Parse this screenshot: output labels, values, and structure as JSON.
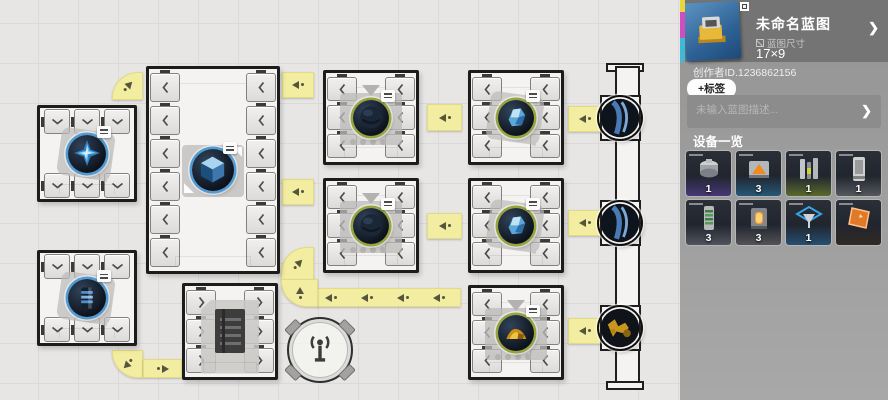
{
  "header": {
    "title": "未命名蓝图",
    "size_label": "蓝图尺寸",
    "size_value": "17×9",
    "chevron": "❯"
  },
  "meta": {
    "creator_id": "创作者ID.1236862156",
    "add_tag_label": "+标签",
    "description_placeholder": "未输入蓝图描述...",
    "chevron": "❯"
  },
  "devices": {
    "section_title": "设备一览",
    "items": [
      {
        "icon": "centrifuge-machine",
        "count": "1",
        "accent": "#7b52d6"
      },
      {
        "icon": "press-machine",
        "count": "3",
        "accent": "#2f9bd8"
      },
      {
        "icon": "pillar-machine",
        "count": "1",
        "accent": "#a9c62c"
      },
      {
        "icon": "cabinet-machine",
        "count": "1",
        "accent": "#9b9b9b"
      },
      {
        "icon": "coil-tower-machine",
        "count": "3",
        "accent": "#8f949b"
      },
      {
        "icon": "furnace-machine",
        "count": "3",
        "accent": "#97928c"
      },
      {
        "icon": "funnel-machine",
        "count": "1",
        "accent": "#2f86c8"
      },
      {
        "icon": "conveyor-panel",
        "count": "",
        "accent": "#4a2f17"
      }
    ]
  },
  "canvas": {
    "grid_cell": 40,
    "machines": [
      {
        "id": "assembler-top-left",
        "x": 37,
        "y": 105,
        "w": 100,
        "h": 97,
        "ports": "tb",
        "pcount": 3,
        "chev": "down",
        "item": "spike-gem",
        "ring": "#4f9bd6",
        "itemd": 38,
        "decor": [
          "shadow",
          "tag"
        ]
      },
      {
        "id": "storage-tall",
        "x": 146,
        "y": 66,
        "w": 134,
        "h": 208,
        "ports": "lr",
        "pcount": 6,
        "chev": "left",
        "item": "cube",
        "ring": "#4f9bd6",
        "itemd": 42,
        "decor": [
          "shadowsq",
          "corner-arrows",
          "tag"
        ]
      },
      {
        "id": "processor-a",
        "x": 323,
        "y": 70,
        "w": 96,
        "h": 95,
        "ports": "lr",
        "pcount": 3,
        "chev": "left",
        "item": "dark-sphere",
        "ring": "#95a53b",
        "itemd": 36,
        "decor": [
          "shadowsq",
          "triangle",
          "dots",
          "tag"
        ]
      },
      {
        "id": "processor-b",
        "x": 468,
        "y": 70,
        "w": 96,
        "h": 95,
        "ports": "lr",
        "pcount": 3,
        "chev": "left",
        "item": "crystal",
        "ring": "#95a53b",
        "itemd": 36,
        "decor": [
          "shadow",
          "tag"
        ]
      },
      {
        "id": "processor-c",
        "x": 323,
        "y": 178,
        "w": 96,
        "h": 95,
        "ports": "lr",
        "pcount": 3,
        "chev": "left",
        "item": "dark-sphere",
        "ring": "#95a53b",
        "itemd": 36,
        "decor": [
          "shadowsq",
          "triangle",
          "dots",
          "tag"
        ]
      },
      {
        "id": "processor-d",
        "x": 468,
        "y": 178,
        "w": 96,
        "h": 95,
        "ports": "lr",
        "pcount": 3,
        "chev": "left",
        "item": "crystal",
        "ring": "#95a53b",
        "itemd": 36,
        "decor": [
          "shadow",
          "tag"
        ]
      },
      {
        "id": "assembler-bottom-left",
        "x": 37,
        "y": 250,
        "w": 100,
        "h": 96,
        "ports": "tb",
        "pcount": 3,
        "chev": "down",
        "item": "capacitor",
        "ring": "#4f9bd6",
        "itemd": 38,
        "decor": [
          "shadow",
          "tag"
        ]
      },
      {
        "id": "shelf-unit",
        "x": 182,
        "y": 283,
        "w": 96,
        "h": 97,
        "ports": "lr",
        "pcount": 3,
        "chev": "right",
        "item": "cabinet",
        "decor": [
          "folder"
        ]
      },
      {
        "id": "processor-e",
        "x": 468,
        "y": 285,
        "w": 96,
        "h": 95,
        "ports": "lr",
        "pcount": 3,
        "chev": "left",
        "item": "gold-ore",
        "ring": "#95a53b",
        "itemd": 36,
        "decor": [
          "shadowsq",
          "triangle",
          "dots",
          "tag"
        ]
      }
    ],
    "belts": [
      {
        "x": 112,
        "y": 72,
        "w": 31,
        "h": 28,
        "shape": "elbow-tl",
        "arrows": [
          {
            "dir": "ne"
          }
        ]
      },
      {
        "x": 282,
        "y": 72,
        "w": 32,
        "h": 26,
        "shape": "straight",
        "arrows": [
          {
            "dir": "w"
          }
        ]
      },
      {
        "x": 427,
        "y": 104,
        "w": 35,
        "h": 27,
        "shape": "straight",
        "arrows": [
          {
            "dir": "w"
          }
        ]
      },
      {
        "x": 568,
        "y": 106,
        "w": 34,
        "h": 26,
        "shape": "straight",
        "arrows": [
          {
            "dir": "w"
          }
        ]
      },
      {
        "x": 282,
        "y": 179,
        "w": 32,
        "h": 26,
        "shape": "straight",
        "arrows": [
          {
            "dir": "w"
          }
        ]
      },
      {
        "x": 427,
        "y": 213,
        "w": 35,
        "h": 26,
        "shape": "straight",
        "arrows": [
          {
            "dir": "w"
          }
        ]
      },
      {
        "x": 568,
        "y": 210,
        "w": 34,
        "h": 26,
        "shape": "straight",
        "arrows": [
          {
            "dir": "w"
          }
        ]
      },
      {
        "x": 568,
        "y": 318,
        "w": 34,
        "h": 26,
        "shape": "straight",
        "arrows": [
          {
            "dir": "w"
          }
        ]
      },
      {
        "x": 317,
        "y": 288,
        "w": 144,
        "h": 19,
        "shape": "straight",
        "arrows": [
          {
            "fx": 0.1,
            "dir": "w"
          },
          {
            "fx": 0.35,
            "dir": "w"
          },
          {
            "fx": 0.6,
            "dir": "w"
          },
          {
            "fx": 0.85,
            "dir": "w"
          }
        ]
      },
      {
        "x": 281,
        "y": 247,
        "w": 33,
        "h": 33,
        "shape": "elbow-tl",
        "arrows": [
          {
            "dir": "ne"
          }
        ]
      },
      {
        "x": 281,
        "y": 279,
        "w": 37,
        "h": 28,
        "shape": "elbow-bl",
        "arrows": [
          {
            "dir": "n"
          }
        ]
      },
      {
        "x": 112,
        "y": 350,
        "w": 31,
        "h": 28,
        "shape": "elbow-bl",
        "arrows": [
          {
            "dir": "sw"
          }
        ]
      },
      {
        "x": 143,
        "y": 359,
        "w": 39,
        "h": 19,
        "shape": "straight",
        "arrows": [
          {
            "dir": "e"
          }
        ]
      }
    ],
    "column": {
      "rails": [
        {
          "x": 606,
          "y": 63,
          "w": 38,
          "h": 9
        },
        {
          "x": 615,
          "y": 66,
          "w": 25,
          "h": 320
        },
        {
          "x": 606,
          "y": 381,
          "w": 38,
          "h": 9
        }
      ],
      "sockets": [
        {
          "x": 600,
          "y": 95,
          "w": 41,
          "h": 46,
          "item": "sphere-blue"
        },
        {
          "x": 600,
          "y": 200,
          "w": 41,
          "h": 46,
          "item": "sphere-blue"
        },
        {
          "x": 600,
          "y": 305,
          "w": 41,
          "h": 46,
          "item": "sphere-gold"
        }
      ]
    }
  }
}
